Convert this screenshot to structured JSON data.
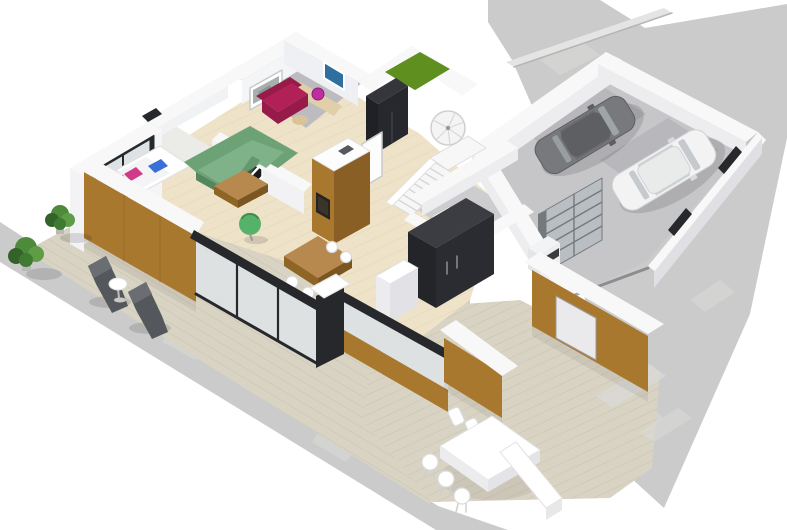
{
  "scene": {
    "type": "3d-floorplan-render",
    "view": "isometric-birdseye",
    "background": "#ffffff",
    "rooms": [
      {
        "name": "living-room",
        "floor": "light-wood",
        "furniture": [
          "corner-sofa-green",
          "coffee-table-wood",
          "egg-chair-green",
          "wall-art-stripes"
        ]
      },
      {
        "name": "bedroom-nook",
        "floor": "pale",
        "furniture": [
          "daybed-white",
          "pillow-pink",
          "laptop-blue",
          "window-black-frame"
        ]
      },
      {
        "name": "lounge-room",
        "floor": "gray",
        "furniture": [
          "loveseat-crimson",
          "wall-art-photo",
          "ottoman-tan"
        ]
      },
      {
        "name": "office-room",
        "floor": "gray",
        "furniture": [
          "desk",
          "chair-magenta",
          "wall-screen-blue"
        ]
      },
      {
        "name": "entry-hall",
        "furniture": [
          "tall-cabinet-black",
          "door-white",
          "staircase-straight",
          "staircase-spiral",
          "fireplace-island-wood"
        ]
      },
      {
        "name": "kitchen-utility",
        "furniture": [
          "wardrobe-black",
          "counter-white",
          "dining-table-wood",
          "chairs-white"
        ]
      },
      {
        "name": "laundry-corner",
        "furniture": [
          "washer-dryer-stack"
        ]
      },
      {
        "name": "storage-room",
        "furniture": [
          "shelving-rack-gray"
        ]
      },
      {
        "name": "garage",
        "floor": "concrete",
        "vehicles": [
          "car-dark-gray",
          "car-white"
        ]
      },
      {
        "name": "terrace-left",
        "floor": "wood-deck",
        "furniture": [
          "lounge-chair-dark",
          "lounge-chair-dark",
          "side-table-round-white",
          "shrub-potted",
          "shrub-potted"
        ]
      },
      {
        "name": "patio-bottom",
        "floor": "wood-deck",
        "furniture": [
          "dining-table-white",
          "dining-chairs-white",
          "bench-white"
        ]
      },
      {
        "name": "roof-cutout",
        "feature": "green-planting-patch"
      }
    ],
    "counts": {
      "vehicles": 2,
      "potted_plants": 2,
      "lounge_chairs": 2,
      "patio_chairs": 6,
      "interior_dining_chairs": 5,
      "staircases": 2
    },
    "exterior": [
      "concrete-driveway",
      "concrete-walkway",
      "parapet-curb",
      "glass-railing-black-frame",
      "wood-clad-facade",
      "white-capped-walls"
    ]
  },
  "colors": {
    "wallWhite": "#f8f8f8",
    "wallFace": "#ededf0",
    "wallShade": "#e0e0e4",
    "wood": "#a9782f",
    "woodDark": "#8a5f26",
    "deck": "#d8d3c3",
    "deckLine": "#c8c2b0",
    "concrete": "#cbcbcb",
    "concreteLight": "#dadad8",
    "floorWood": "#eee2c8",
    "floorLine": "#e2d5b8",
    "floorGray": "#bcbcc0",
    "floorPale": "#ebebe8",
    "garageFloor": "#c6c6c9",
    "parkShade": "#b2b2b6",
    "frameBlack": "#26282c",
    "glass": "#dde2e4",
    "sofaGreen": "#6da277",
    "sofaGreenLight": "#7fb289",
    "sofaGreenDark": "#55875f",
    "eggGreen": "#57b269",
    "crimson": "#b12057",
    "crimsonDark": "#961b49",
    "magenta": "#c02da0",
    "pink": "#d13a8a",
    "blue": "#3a6fd8",
    "bluePic": "#2f6f9f",
    "tableWood": "#b8894e",
    "tableWoodDark": "#8f6526",
    "carGray": "#77797c",
    "carGrayDark": "#5d5f62",
    "carWindow": "#9fa4a7",
    "carWhite": "#f3f3f4",
    "metal": "#b9bec2",
    "metalDark": "#74797d",
    "grassGreen": "#5f8f1f",
    "plantGreen": "#4e8a3c",
    "plantDark": "#33632a",
    "darkChair": "#54585c",
    "shadow": "rgba(0,0,0,0.12)",
    "shadowSoft": "rgba(0,0,0,0.06)",
    "white": "#ffffff"
  }
}
